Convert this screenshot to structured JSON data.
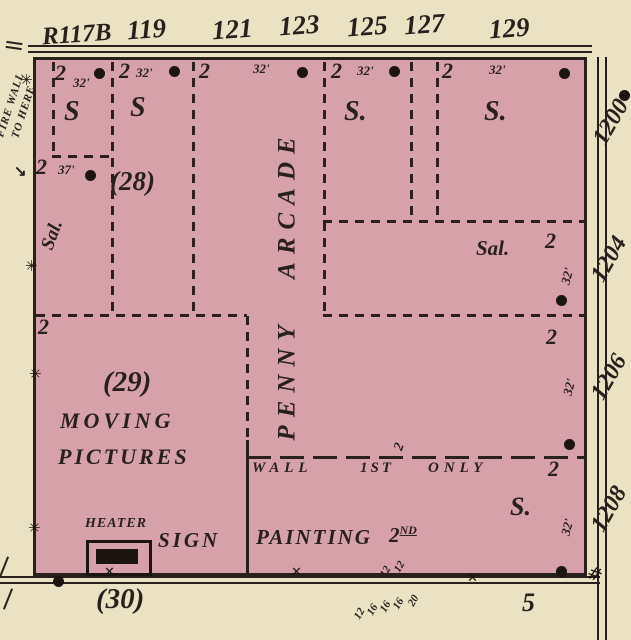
{
  "colors": {
    "paper": "#eae2c2",
    "block_fill": "#d7a1a9",
    "ink": "#28201c"
  },
  "top_addresses": [
    "R117B",
    "119",
    "121",
    "123",
    "125",
    "127",
    "129"
  ],
  "right_addresses": [
    "1200",
    "1204",
    "1206",
    "1208"
  ],
  "fire_wall": {
    "line1": "FIRE WALL",
    "line2": "TO HERE"
  },
  "bays": [
    {
      "story": "2",
      "depth": "32'",
      "use": "S"
    },
    {
      "story": "2",
      "depth": "32'",
      "use": "S"
    },
    {
      "story": "2",
      "depth": "32'",
      "use": ""
    },
    {
      "story": "2",
      "depth": "32'",
      "use": "S."
    },
    {
      "story": "2",
      "depth": "32'",
      "use": "S."
    }
  ],
  "arcade": {
    "name": "PENNY ARCADE"
  },
  "parcel_28": {
    "number": "(28)",
    "story": "2",
    "depth": "37'"
  },
  "saloon_left": {
    "label": "Sal."
  },
  "left_story": "2",
  "saloon_right": {
    "label": "Sal.",
    "story": "2",
    "depth": "32'"
  },
  "mid_right": {
    "story": "2",
    "depth": "32'"
  },
  "parcel_29": {
    "number": "(29)",
    "use_line1": "MOVING",
    "use_line2": "PICTURES"
  },
  "wall_note": {
    "wall": "WALL",
    "first": "1ST",
    "only": "ONLY",
    "story": "2"
  },
  "store_right": {
    "story": "2",
    "use": "S.",
    "depth": "32'"
  },
  "heater": {
    "label": "HEATER"
  },
  "sign_painting": {
    "word1": "SIGN",
    "word2": "PAINTING",
    "num": "2",
    "sup": "ND"
  },
  "parcel_30": {
    "number": "(30)"
  },
  "bottom_right_number": "5",
  "dims_above_line": [
    "12",
    "12"
  ],
  "dims_below_line": [
    "12",
    "16",
    "16",
    "16",
    "20"
  ]
}
